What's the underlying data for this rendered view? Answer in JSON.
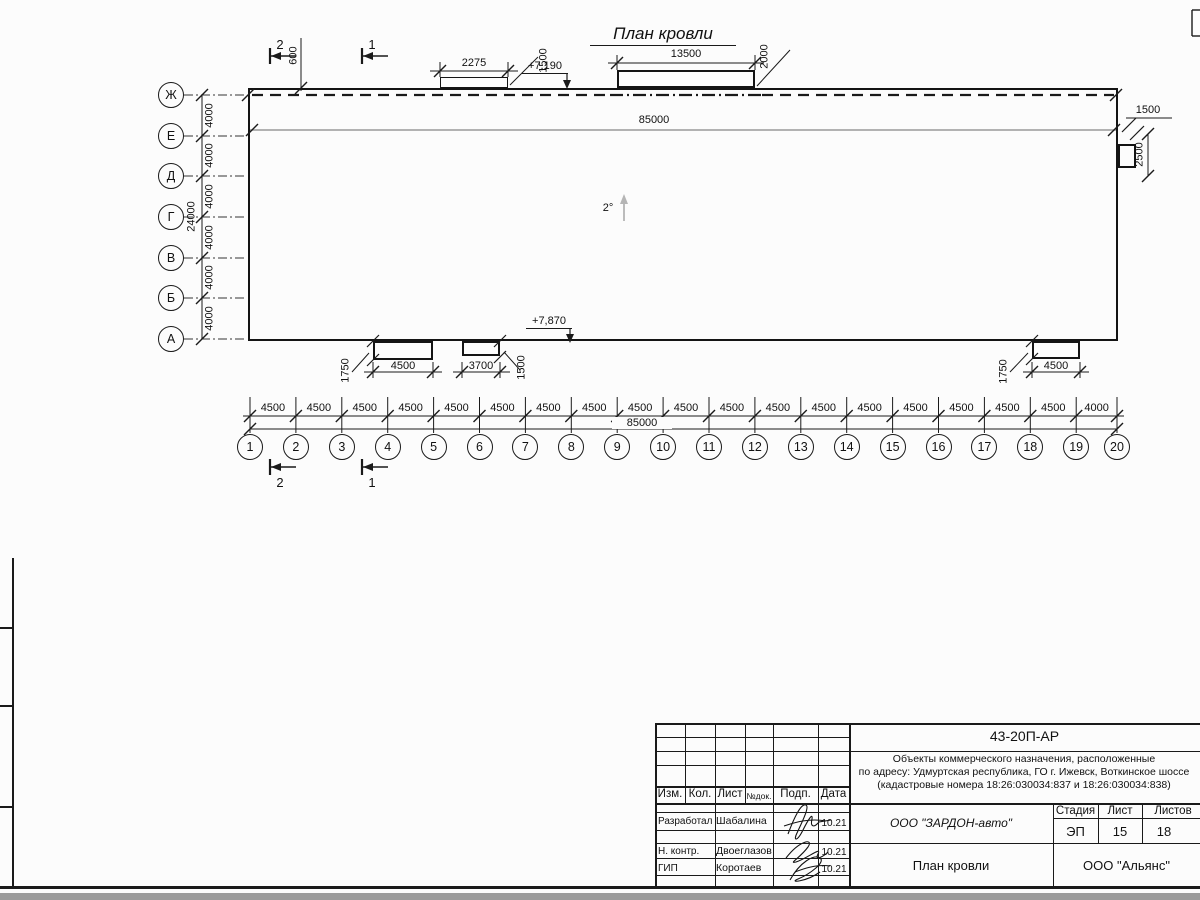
{
  "colors": {
    "line": "#1a1a1a",
    "gray_line": "#9a9a9a",
    "background": "#fcfcfc",
    "scan_edge": "#9b9b9b",
    "light_arrow": "#b5b5b5"
  },
  "drawing": {
    "title": "План кровли",
    "slope": "2°",
    "elevation_top": "+7,190",
    "elevation_bottom": "+7,870",
    "dims": {
      "offset_600": "600",
      "hatch_2275": "2275",
      "hatch_1500_top": "1500",
      "hatch_13500": "13500",
      "hatch_2000": "2000",
      "width_85000_top": "85000",
      "right_1500": "1500",
      "right_2500": "2500",
      "canopy_a_4500": "4500",
      "canopy_a_1750": "1750",
      "canopy_b_3700": "3700",
      "canopy_b_1500": "1500",
      "canopy_c_4500": "4500",
      "canopy_c_1750": "1750",
      "width_85000_bottom": "85000"
    },
    "section_markers": {
      "m1": "1",
      "m2": "2"
    },
    "axes_left": {
      "labels": [
        "Ж",
        "Е",
        "Д",
        "Г",
        "В",
        "Б",
        "А"
      ],
      "spacings": [
        "4000",
        "4000",
        "4000",
        "4000",
        "4000",
        "4000"
      ],
      "total": "24000"
    },
    "axes_bottom": {
      "labels": [
        "1",
        "2",
        "3",
        "4",
        "5",
        "6",
        "7",
        "8",
        "9",
        "10",
        "11",
        "12",
        "13",
        "14",
        "15",
        "16",
        "17",
        "18",
        "19",
        "20"
      ],
      "spacings": [
        "4500",
        "4500",
        "4500",
        "4500",
        "4500",
        "4500",
        "4500",
        "4500",
        "4500",
        "4500",
        "4500",
        "4500",
        "4500",
        "4500",
        "4500",
        "4500",
        "4500",
        "4500",
        "4000"
      ],
      "total": "85000"
    }
  },
  "title_block": {
    "doc_number": "43-20П-АР",
    "description_lines": [
      "Объекты коммерческого назначения, расположенные",
      "по адресу: Удмуртская республика, ГО г. Ижевск, Воткинское шоссе",
      "(кадастровые номера 18:26:030034:837 и 18:26:030034:838)"
    ],
    "columns": [
      "Изм.",
      "Кол.",
      "Лист",
      "№док.",
      "Подп.",
      "Дата"
    ],
    "signature_rows": [
      {
        "role": "Разработал",
        "name": "Шабалина",
        "date": "10.21"
      },
      {
        "role": "Н. контр.",
        "name": "Двоеглазов",
        "date": "10.21"
      },
      {
        "role": "ГИП",
        "name": "Коротаев",
        "date": "10.21"
      }
    ],
    "company": "ООО \"ЗАРДОН-авто\"",
    "stage_label": "Стадия",
    "sheet_label": "Лист",
    "sheets_label": "Листов",
    "stage_value": "ЭП",
    "sheet_value": "15",
    "sheets_value": "18",
    "drawing_name": "План кровли",
    "organization": "ООО \"Альянс\""
  }
}
